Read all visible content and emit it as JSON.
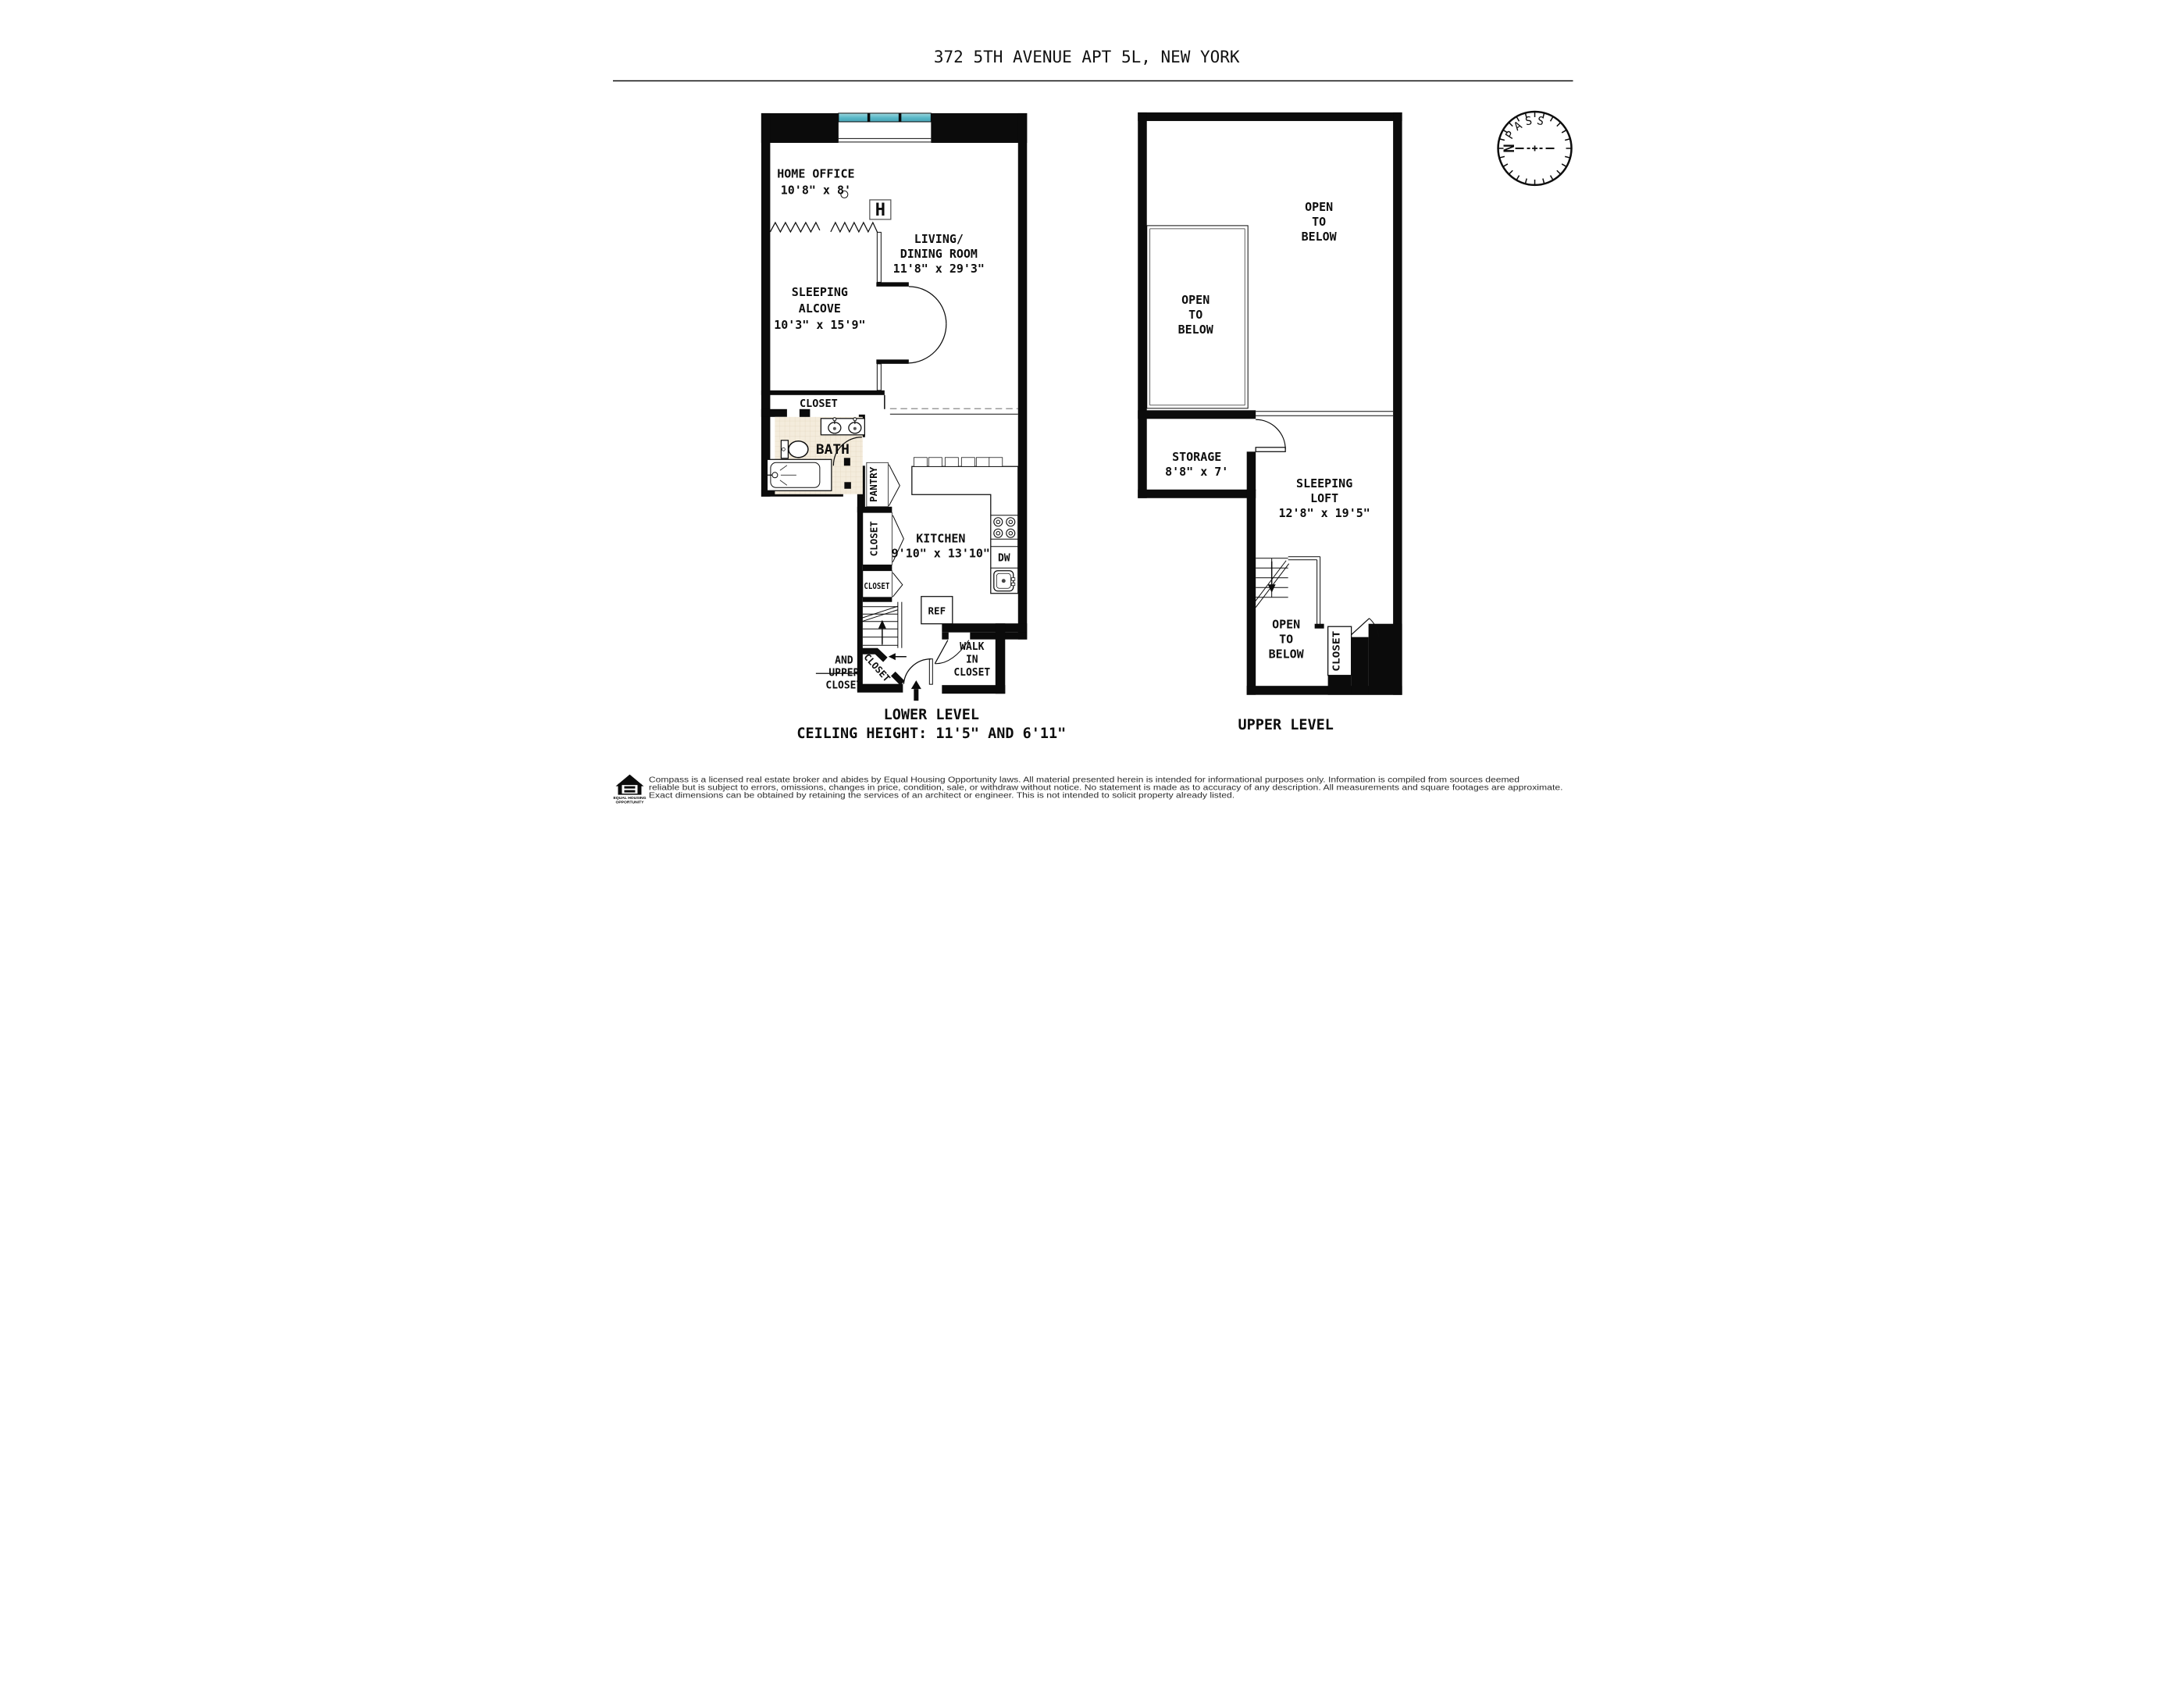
{
  "header": {
    "title": "372 5TH AVENUE APT 5L, NEW YORK"
  },
  "lower_level": {
    "caption_line1": "LOWER LEVEL",
    "caption_line2": "CEILING HEIGHT: 11'5\" AND 6'11\"",
    "home_office": {
      "name": "HOME OFFICE",
      "dims": "10'8\" x 8'"
    },
    "radiator": "H",
    "living_dining": {
      "name_line1": "LIVING/",
      "name_line2": "DINING ROOM",
      "dims": "11'8\" x 29'3\""
    },
    "sleeping_alcove": {
      "name_line1": "SLEEPING",
      "name_line2": "ALCOVE",
      "dims": "10'3\" x 15'9\""
    },
    "alcove_closet": "CLOSET",
    "bath": "BATH",
    "pantry": "PANTRY",
    "hall_closet_upper": "CLOSET",
    "hall_closet_lower": "CLOSET",
    "stair_closet": "CLOSET",
    "stair_closet_note": {
      "line1": "AND",
      "line2": "UPPER",
      "line3": "CLOSET"
    },
    "kitchen": {
      "name": "KITCHEN",
      "dims": "9'10\" x 13'10\""
    },
    "dishwasher": "DW",
    "refrigerator": "REF",
    "walk_in_closet": {
      "line1": "WALK",
      "line2": "IN",
      "line3": "CLOSET"
    }
  },
  "upper_level": {
    "caption": "UPPER LEVEL",
    "open_to_below": {
      "line1": "OPEN",
      "line2": "TO",
      "line3": "BELOW"
    },
    "storage": {
      "name": "STORAGE",
      "dims": "8'8\" x 7'"
    },
    "sleeping_loft": {
      "name_line1": "SLEEPING",
      "name_line2": "LOFT",
      "dims": "12'8\" x 19'5\""
    },
    "loft_closet": "CLOSET"
  },
  "compass": {
    "brand": "COMPASS",
    "north": "N"
  },
  "footer": {
    "equal_housing_logo": {
      "line1": "EQUAL HOUSING",
      "line2": "OPPORTUNITY"
    },
    "disclaimer_line1": "Compass is a licensed real estate broker and abides by Equal Housing Opportunity laws. All material presented herein is intended for informational purposes only. Information is compiled from sources deemed",
    "disclaimer_line2": "reliable but is subject to errors, omissions, changes in price, condition, sale, or withdraw without notice. No statement is made as to accuracy of any description. All measurements and square footages are approximate.",
    "disclaimer_line3": "Exact dimensions can be obtained by retaining the services of an architect or engineer. This is not intended to solicit property already listed."
  },
  "colors": {
    "window_teal": "#57B7C7",
    "north_red": "#E03228",
    "tile": "#F4ECDC",
    "wall": "#0B0B0B"
  }
}
